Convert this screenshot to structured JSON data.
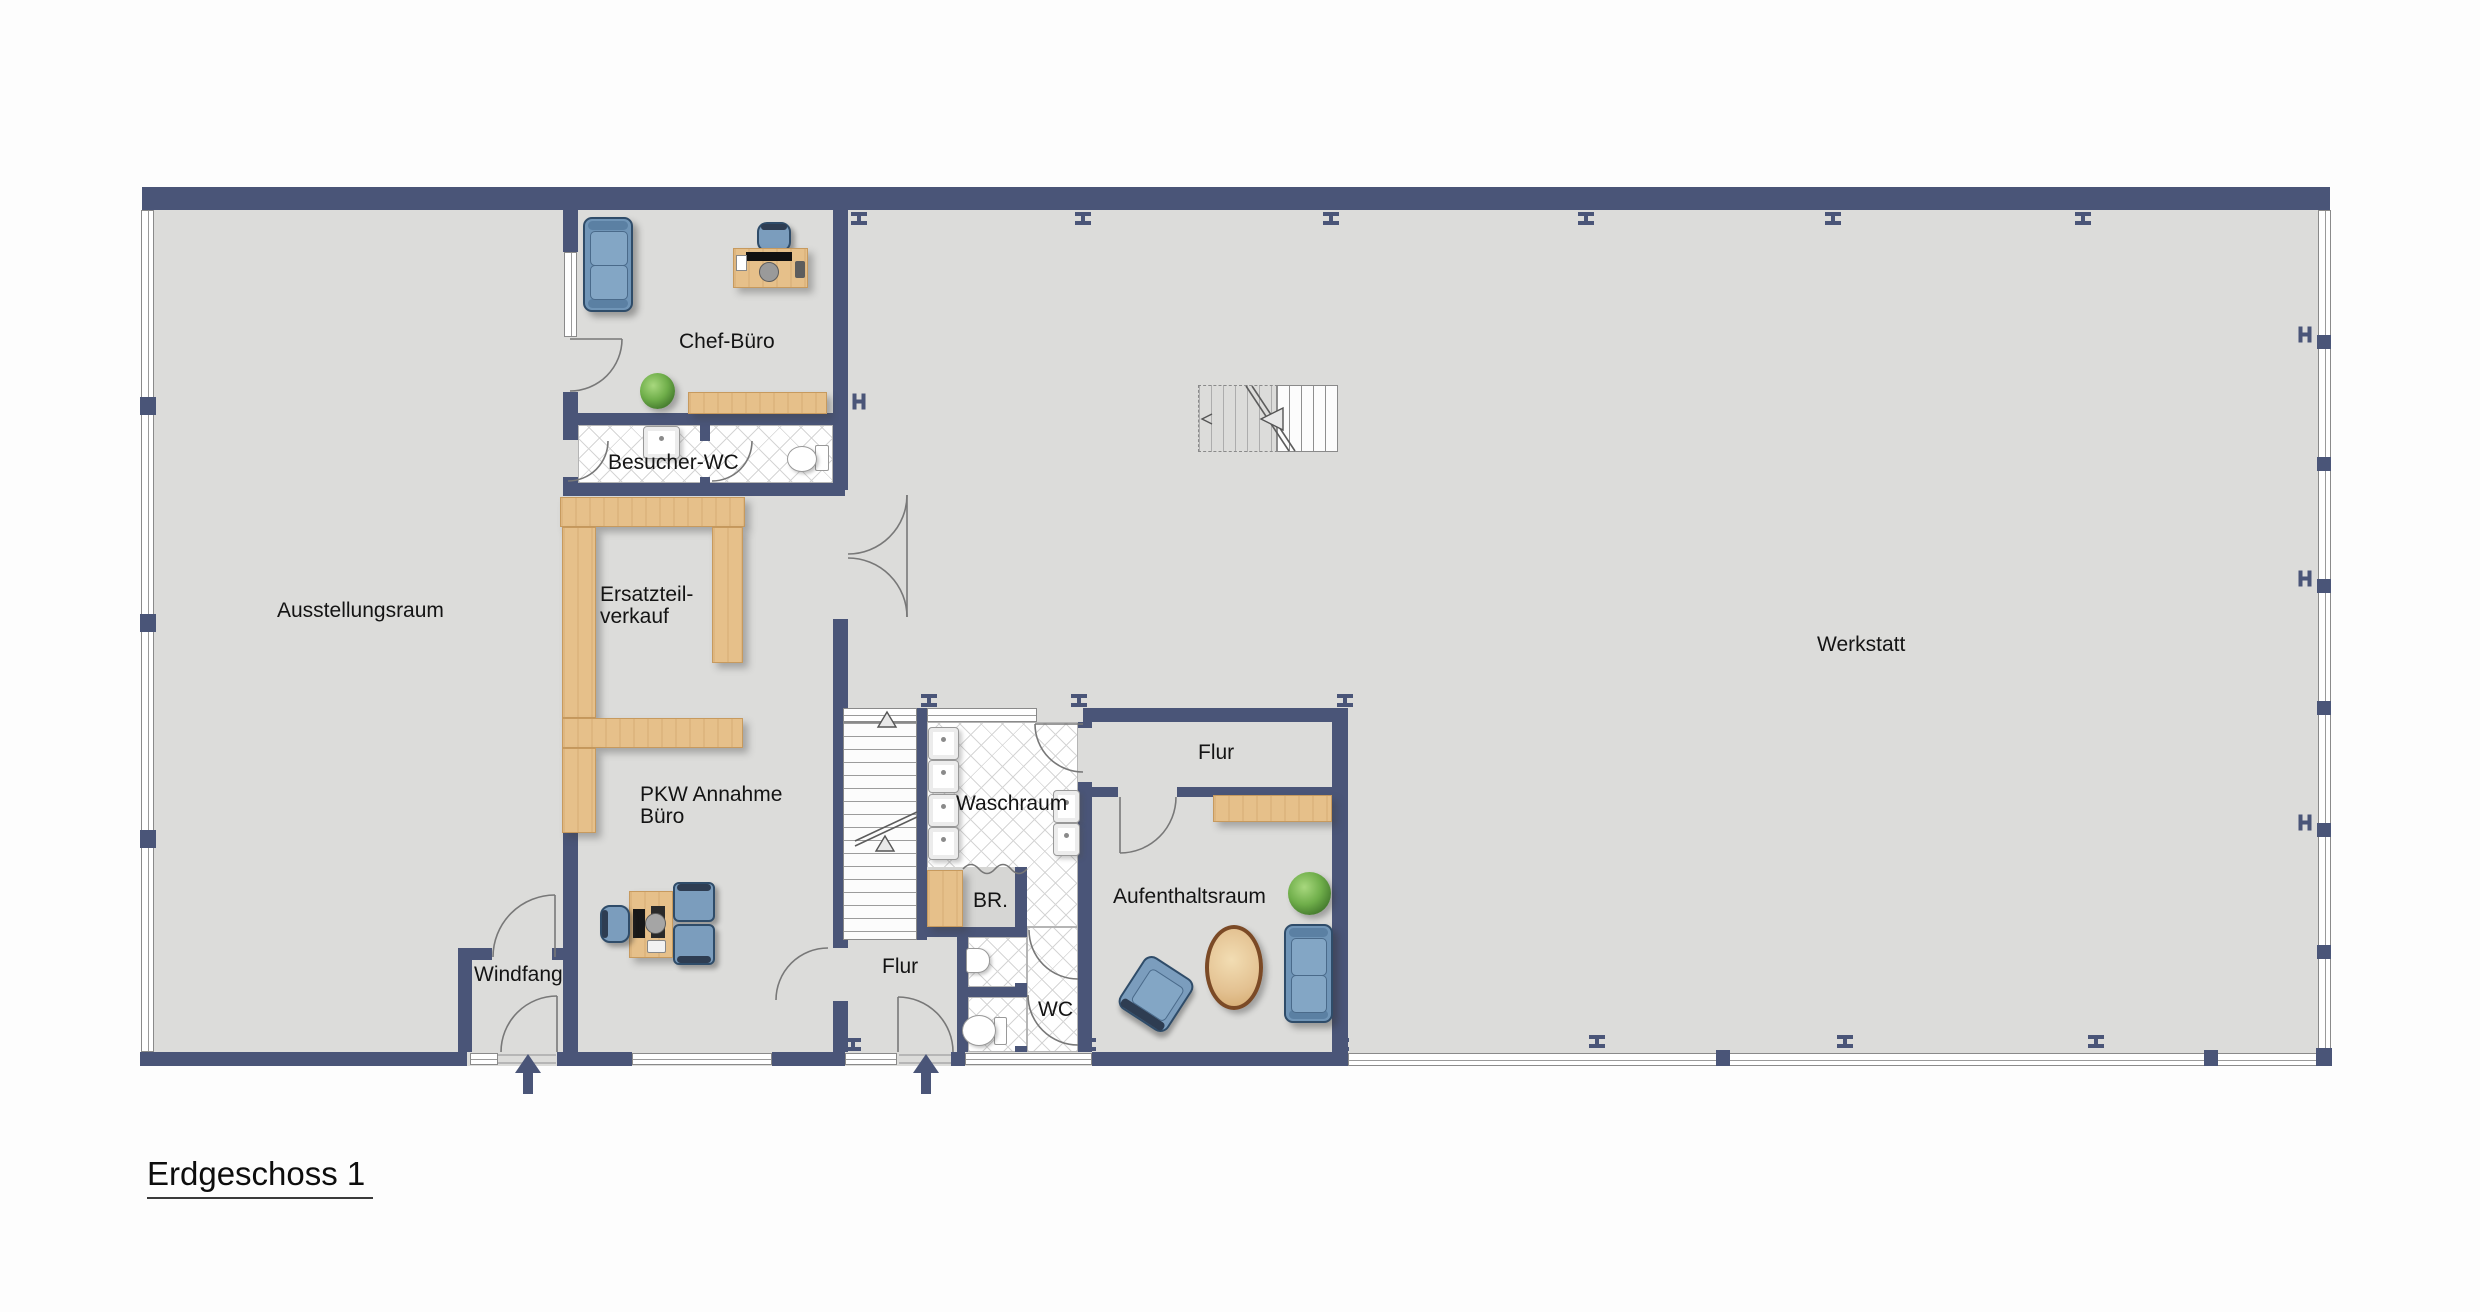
{
  "title": "Erdgeschoss 1",
  "labels": {
    "ausstellungsraum": "Ausstellungsraum",
    "chef_buero": "Chef-Büro",
    "besucher_wc": "Besucher-WC",
    "ersatzteil_line1": "Ersatzteil-",
    "ersatzteil_line2": "verkauf",
    "pkw_line1": "PKW Annahme",
    "pkw_line2": "Büro",
    "windfang": "Windfang",
    "flur_mitte": "Flur",
    "waschraum": "Waschraum",
    "br": "BR.",
    "wc": "WC",
    "aufenthaltsraum": "Aufenthaltsraum",
    "flur_rechts": "Flur",
    "werkstatt": "Werkstatt"
  },
  "colors": {
    "wall": "#4a5578",
    "floor": "#dcdcda",
    "wood": "#e6c08a",
    "upholstery_blue": "#7095b7",
    "tile_white": "#ffffff",
    "plant_green": "#6fae4a",
    "table_rim_brown": "#7b4a26"
  }
}
